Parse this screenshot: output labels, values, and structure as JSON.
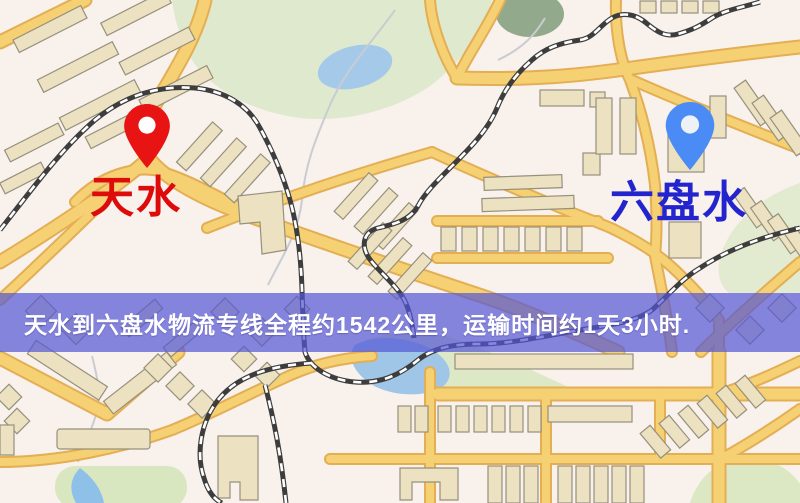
{
  "page": {
    "title": "物流专线地图"
  },
  "markers": {
    "origin": {
      "label": "天水",
      "pin_color": "#e81414",
      "label_color": "#de0b0b"
    },
    "destination": {
      "label": "六盘水",
      "pin_color": "#4b8bf5",
      "label_color": "#2424cf"
    }
  },
  "banner": {
    "text": "天水到六盘水物流专线全程约1542公里，运输时间约1天3小时.",
    "background_color": "#5456d6",
    "text_color": "#ffffff"
  },
  "map_palette": {
    "background": "#f8f1ec",
    "road_fill": "#f6d174",
    "road_casing": "#e3ae54",
    "park_green": "#dfe9cd",
    "water_blue": "#a5cae9",
    "building_tan": "#ece2c2",
    "railway_dark": "#3d3d3d"
  }
}
